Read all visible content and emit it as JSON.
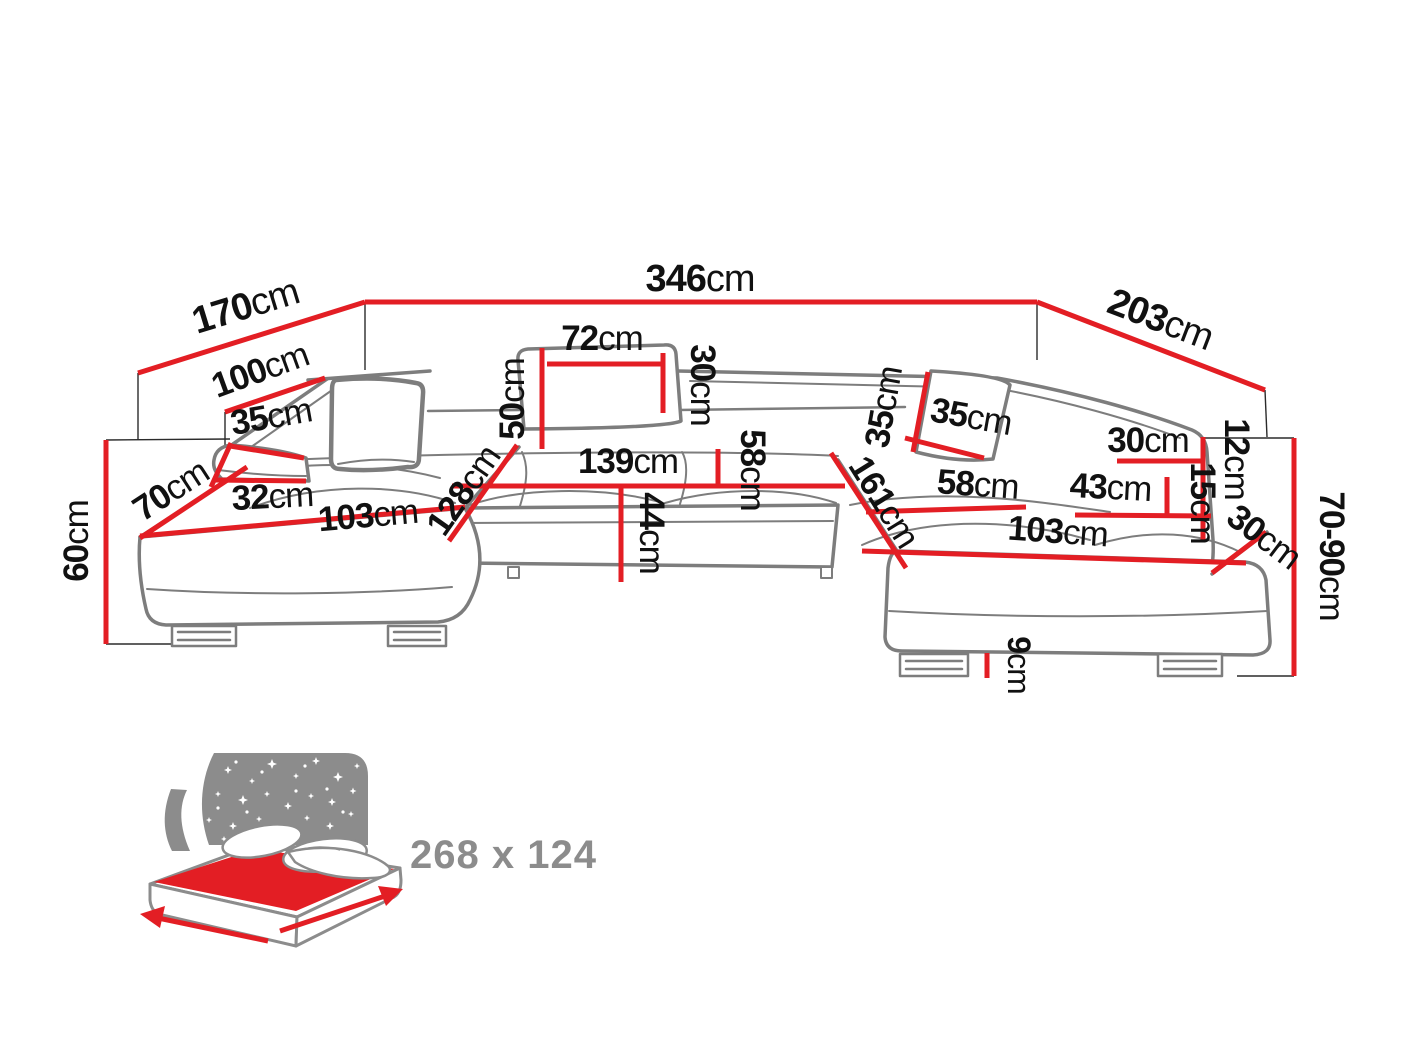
{
  "diagram": {
    "title": "Corner sofa dimensions diagram",
    "unit": "cm",
    "colors": {
      "dimension_line": "#e31e24",
      "sofa_outline": "#7d7d7d",
      "label_text": "#111111",
      "icon_gray": "#8c8c8c"
    },
    "dimensions": [
      {
        "name": "back-total-width",
        "value": "346",
        "unit": "cm"
      },
      {
        "name": "left-side-depth",
        "value": "170",
        "unit": "cm"
      },
      {
        "name": "right-side-depth",
        "value": "203",
        "unit": "cm"
      },
      {
        "name": "left-backrest-length",
        "value": "100",
        "unit": "cm"
      },
      {
        "name": "left-armrest-height",
        "value": "35",
        "unit": "cm"
      },
      {
        "name": "left-armrest-front-width",
        "value": "32",
        "unit": "cm"
      },
      {
        "name": "left-chaise-front-depth",
        "value": "70",
        "unit": "cm"
      },
      {
        "name": "left-chaise-length",
        "value": "103",
        "unit": "cm"
      },
      {
        "name": "left-chaise-diagonal",
        "value": "128",
        "unit": "cm"
      },
      {
        "name": "seat-height-left",
        "value": "60",
        "unit": "cm"
      },
      {
        "name": "backrest-height",
        "value": "50",
        "unit": "cm"
      },
      {
        "name": "headrest-width",
        "value": "72",
        "unit": "cm"
      },
      {
        "name": "headrest-height",
        "value": "30",
        "unit": "cm"
      },
      {
        "name": "center-seat-width",
        "value": "139",
        "unit": "cm"
      },
      {
        "name": "center-seat-depth",
        "value": "58",
        "unit": "cm"
      },
      {
        "name": "center-seat-height",
        "value": "44",
        "unit": "cm"
      },
      {
        "name": "right-back-cushion-height",
        "value": "35",
        "unit": "cm"
      },
      {
        "name": "right-back-cushion-width",
        "value": "35",
        "unit": "cm"
      },
      {
        "name": "right-chaise-diagonal",
        "value": "161",
        "unit": "cm"
      },
      {
        "name": "right-seat-depth",
        "value": "58",
        "unit": "cm"
      },
      {
        "name": "right-chaise-length",
        "value": "103",
        "unit": "cm"
      },
      {
        "name": "right-armrest-width",
        "value": "43",
        "unit": "cm"
      },
      {
        "name": "right-armrest-top-width",
        "value": "30",
        "unit": "cm"
      },
      {
        "name": "right-edge-upper",
        "value": "12",
        "unit": "cm"
      },
      {
        "name": "right-edge-lower",
        "value": "15",
        "unit": "cm"
      },
      {
        "name": "right-corner-edge",
        "value": "30",
        "unit": "cm"
      },
      {
        "name": "overall-height-range",
        "value": "70-90",
        "unit": "cm"
      },
      {
        "name": "leg-height",
        "value": "9",
        "unit": "cm"
      }
    ],
    "sleeping_area": {
      "icon": "sleeping-function-icon",
      "label": "268 x 124"
    }
  }
}
